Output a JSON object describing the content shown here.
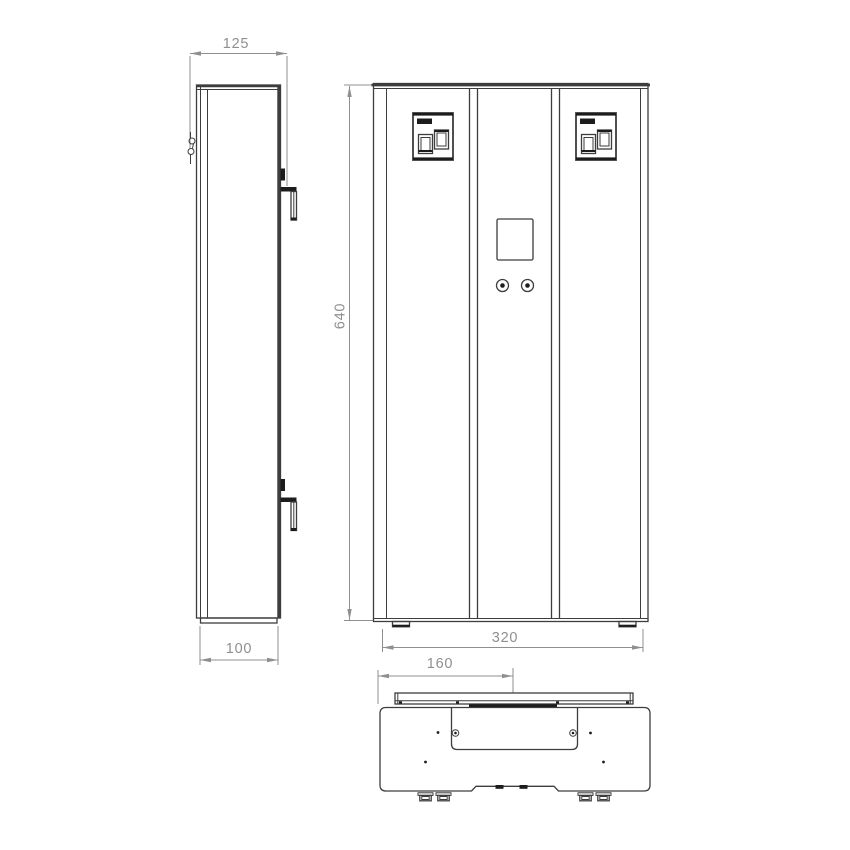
{
  "page": {
    "background": "#ffffff"
  },
  "drawing": {
    "type": "technical-dimension-drawing",
    "views": {
      "side": {
        "name": "side-view",
        "dims": {
          "top_depth": "125",
          "bottom_depth": "100"
        }
      },
      "front": {
        "name": "front-view",
        "dims": {
          "height": "640",
          "width": "320"
        }
      },
      "bottom": {
        "name": "bottom-view",
        "dims": {
          "half_width": "160"
        }
      }
    },
    "colors": {
      "line": "#3d3d3d",
      "line_dark": "#1c1c1c",
      "dimension": "#8f8f8f"
    }
  }
}
